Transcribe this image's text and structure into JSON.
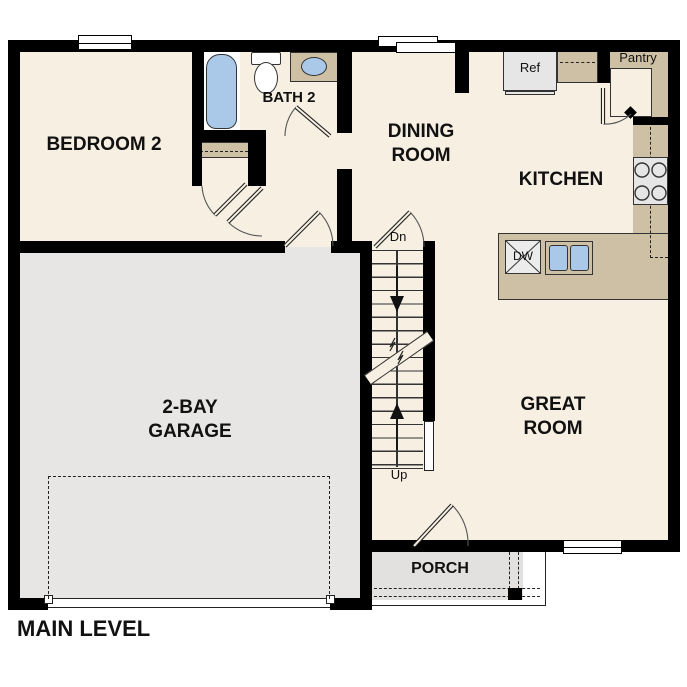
{
  "title": "MAIN LEVEL",
  "rooms": {
    "bedroom2": "BEDROOM 2",
    "bath2": "BATH 2",
    "dining": "DINING ROOM",
    "kitchen": "KITCHEN",
    "great_room": "GREAT ROOM",
    "garage": "2-BAY GARAGE",
    "porch": "PORCH"
  },
  "labels": {
    "ref": "Ref",
    "pantry": "Pantry",
    "dishwasher": "DW",
    "stairs_down": "Dn",
    "stairs_up": "Up"
  },
  "colors": {
    "wall": "#000000",
    "floor": "#f6efe2",
    "garage_floor": "#e7e6e4",
    "porch_floor": "#e2e1df",
    "counter_tan": "#cec0a4",
    "water_blue": "#aac9e8",
    "appliance_gray": "#e6e6e6"
  }
}
